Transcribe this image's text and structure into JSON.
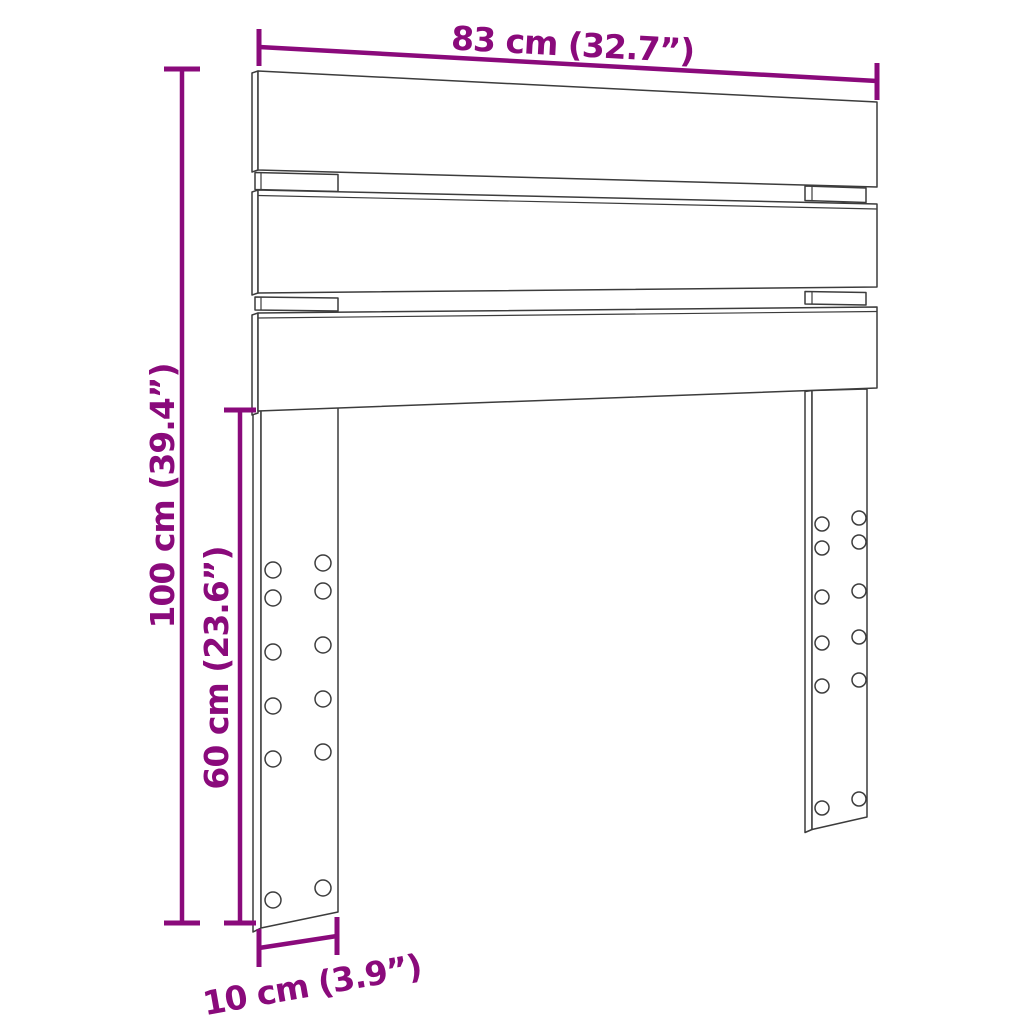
{
  "diagram": {
    "title": "Headboard dimension diagram",
    "background_color": "#ffffff",
    "outline_color": "#3c3c3c",
    "dimension_color": "#8a0a7b",
    "dimensions": {
      "width": {
        "label": "83 cm (32.7”)",
        "cm": 83,
        "inches": 32.7,
        "position": "top"
      },
      "height": {
        "label": "100 cm (39.4”)",
        "cm": 100,
        "inches": 39.4,
        "position": "left-outer"
      },
      "leg_height": {
        "label": "60 cm (23.6”)",
        "cm": 60,
        "inches": 23.6,
        "position": "left-inner"
      },
      "leg_width": {
        "label": "10 cm (3.9”)",
        "cm": 10,
        "inches": 3.9,
        "position": "bottom-left"
      }
    },
    "parts": {
      "slat_count": 3,
      "leg_count": 2,
      "holes_per_leg": 12
    }
  }
}
